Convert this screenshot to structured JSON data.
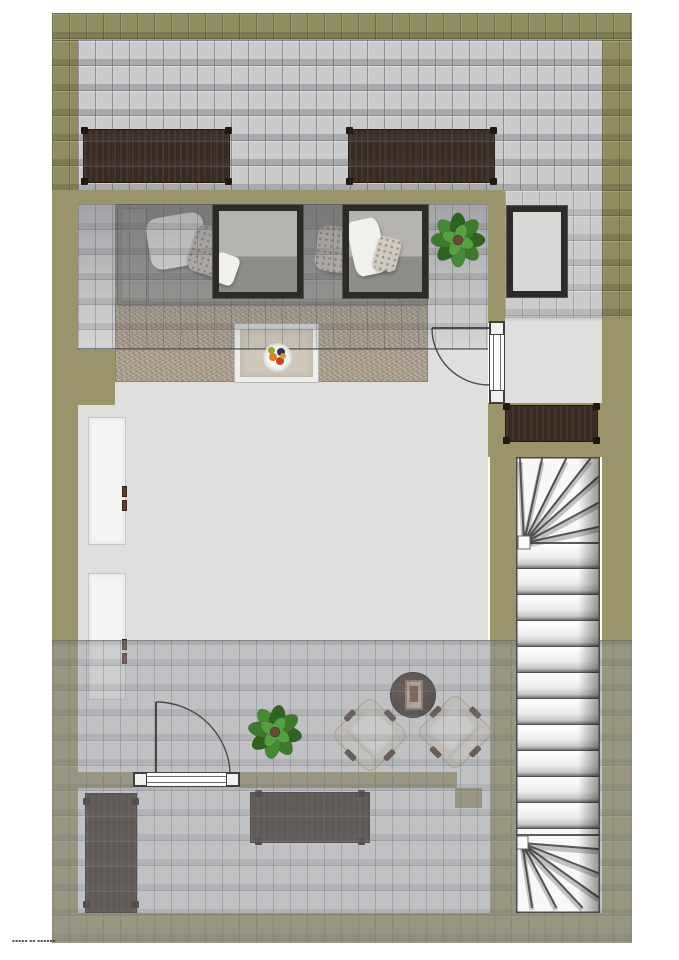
{
  "document": {
    "type": "rendered 3D top-down floor plan, attic storey with pitched roof",
    "watermark_text": "▪▪▪▪▪ ▪▪ ▪▪▪▪▪▪"
  },
  "palette": {
    "wall_olive": "#99946a",
    "wall_olive_tiled": "#8f8c60",
    "roof_tile_gray": "#cbcbcc",
    "floor_gray": "#dfdfdd",
    "carpet_beige": "#aca08e",
    "furniture_dark_brown": "#382b22",
    "stair_white": "#f8f8f7",
    "plant_green": "#3c7a2c",
    "window_frame_dark": "#2c2b28"
  },
  "items": {
    "roof_areas": [
      "top-roof-surface",
      "right-roof-surface",
      "bottom-roof-surface"
    ],
    "furniture": [
      "sideboard-top-left",
      "sideboard-top-right",
      "sofa-with-pillows",
      "carpet",
      "coffee-table-with-fruit-bowl",
      "white-cabinet-upper",
      "white-cabinet-lower",
      "hall-sideboard",
      "round-side-table",
      "armchair-left",
      "armchair-right",
      "wardrobe-bottom-left",
      "sideboard-bottom",
      "plant-top",
      "plant-bottom"
    ],
    "openings": [
      "roof-window-left",
      "roof-window-right",
      "skylight-right",
      "door-hall",
      "door-bottom-room"
    ],
    "circulation": [
      "winder-staircase"
    ]
  }
}
